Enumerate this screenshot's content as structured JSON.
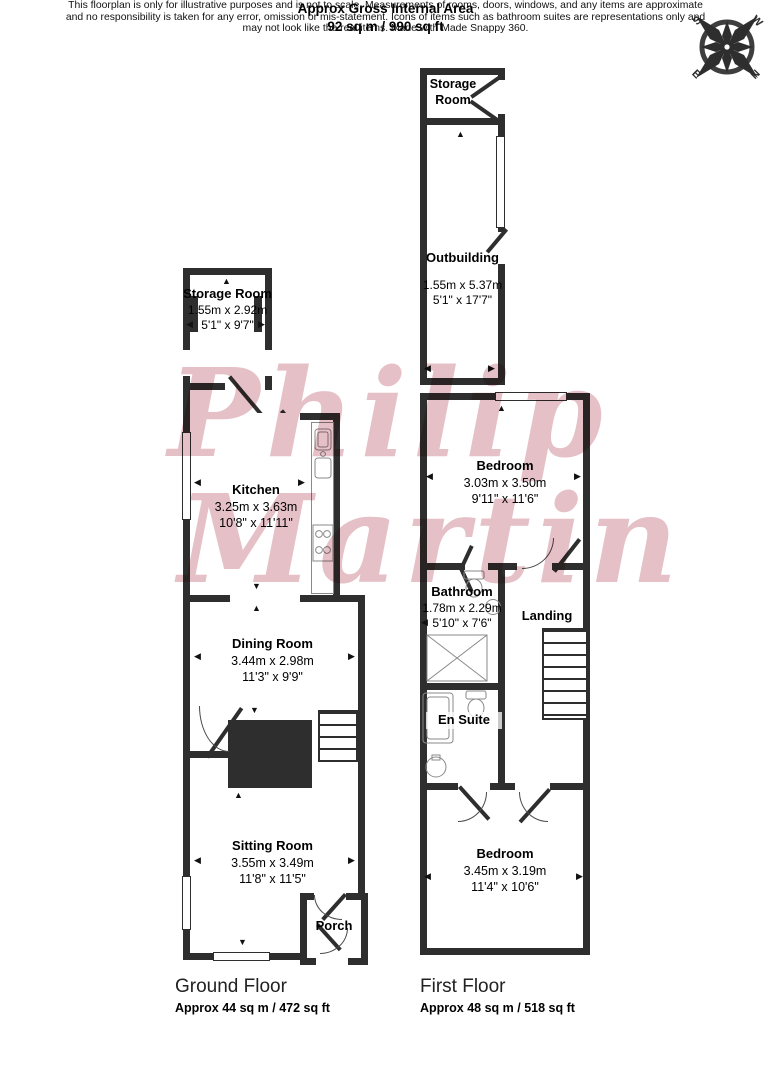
{
  "header": {
    "line1": "Approx Gross Internal Area",
    "line2": "92 sq m / 990 sq ft"
  },
  "compass": {
    "n": "N",
    "s": "S",
    "e": "E",
    "w": "W"
  },
  "watermark": {
    "line1": "Philip",
    "line2": "Martin"
  },
  "icons": {
    "arrow_up": "▲",
    "arrow_down": "▼",
    "arrow_left": "◀",
    "arrow_right": "▶"
  },
  "colors": {
    "wall": "#2e2e2e",
    "watermark": "#ce8694"
  },
  "ground_floor": {
    "label": "Ground Floor",
    "area": "Approx 44 sq m / 472 sq ft",
    "rooms": {
      "storage": {
        "name": "Storage Room",
        "metric": "1.55m x 2.92m",
        "imperial": "5'1\" x 9'7\""
      },
      "kitchen": {
        "name": "Kitchen",
        "metric": "3.25m x 3.63m",
        "imperial": "10'8\" x 11'11\""
      },
      "dining": {
        "name": "Dining Room",
        "metric": "3.44m x 2.98m",
        "imperial": "11'3\" x 9'9\""
      },
      "sitting": {
        "name": "Sitting Room",
        "metric": "3.55m x 3.49m",
        "imperial": "11'8\" x 11'5\""
      },
      "porch": {
        "name": "Porch"
      }
    }
  },
  "first_floor": {
    "label": "First Floor",
    "area": "Approx 48 sq m / 518 sq ft",
    "rooms": {
      "storage": {
        "name": "Storage Room"
      },
      "outbuilding": {
        "name": "Outbuilding",
        "metric": "1.55m x 5.37m",
        "imperial": "5'1\" x 17'7\""
      },
      "bedroom1": {
        "name": "Bedroom",
        "metric": "3.03m x 3.50m",
        "imperial": "9'11\" x 11'6\""
      },
      "bathroom": {
        "name": "Bathroom",
        "metric": "1.78m x 2.29m",
        "imperial": "5'10\" x 7'6\""
      },
      "landing": {
        "name": "Landing"
      },
      "ensuite": {
        "name": "En Suite"
      },
      "bedroom2": {
        "name": "Bedroom",
        "metric": "3.45m x 3.19m",
        "imperial": "11'4\" x 10'6\""
      }
    }
  },
  "footer": {
    "line1": "This floorplan is only for illustrative purposes and is not to scale. Measurements of rooms, doors, windows, and any items are approximate",
    "line2": "and no responsibility is taken for any error, omission or mis-statement. Icons of items such as bathroom suites are representations only and",
    "line3": "may not look like the real items. Made with Made Snappy 360."
  }
}
